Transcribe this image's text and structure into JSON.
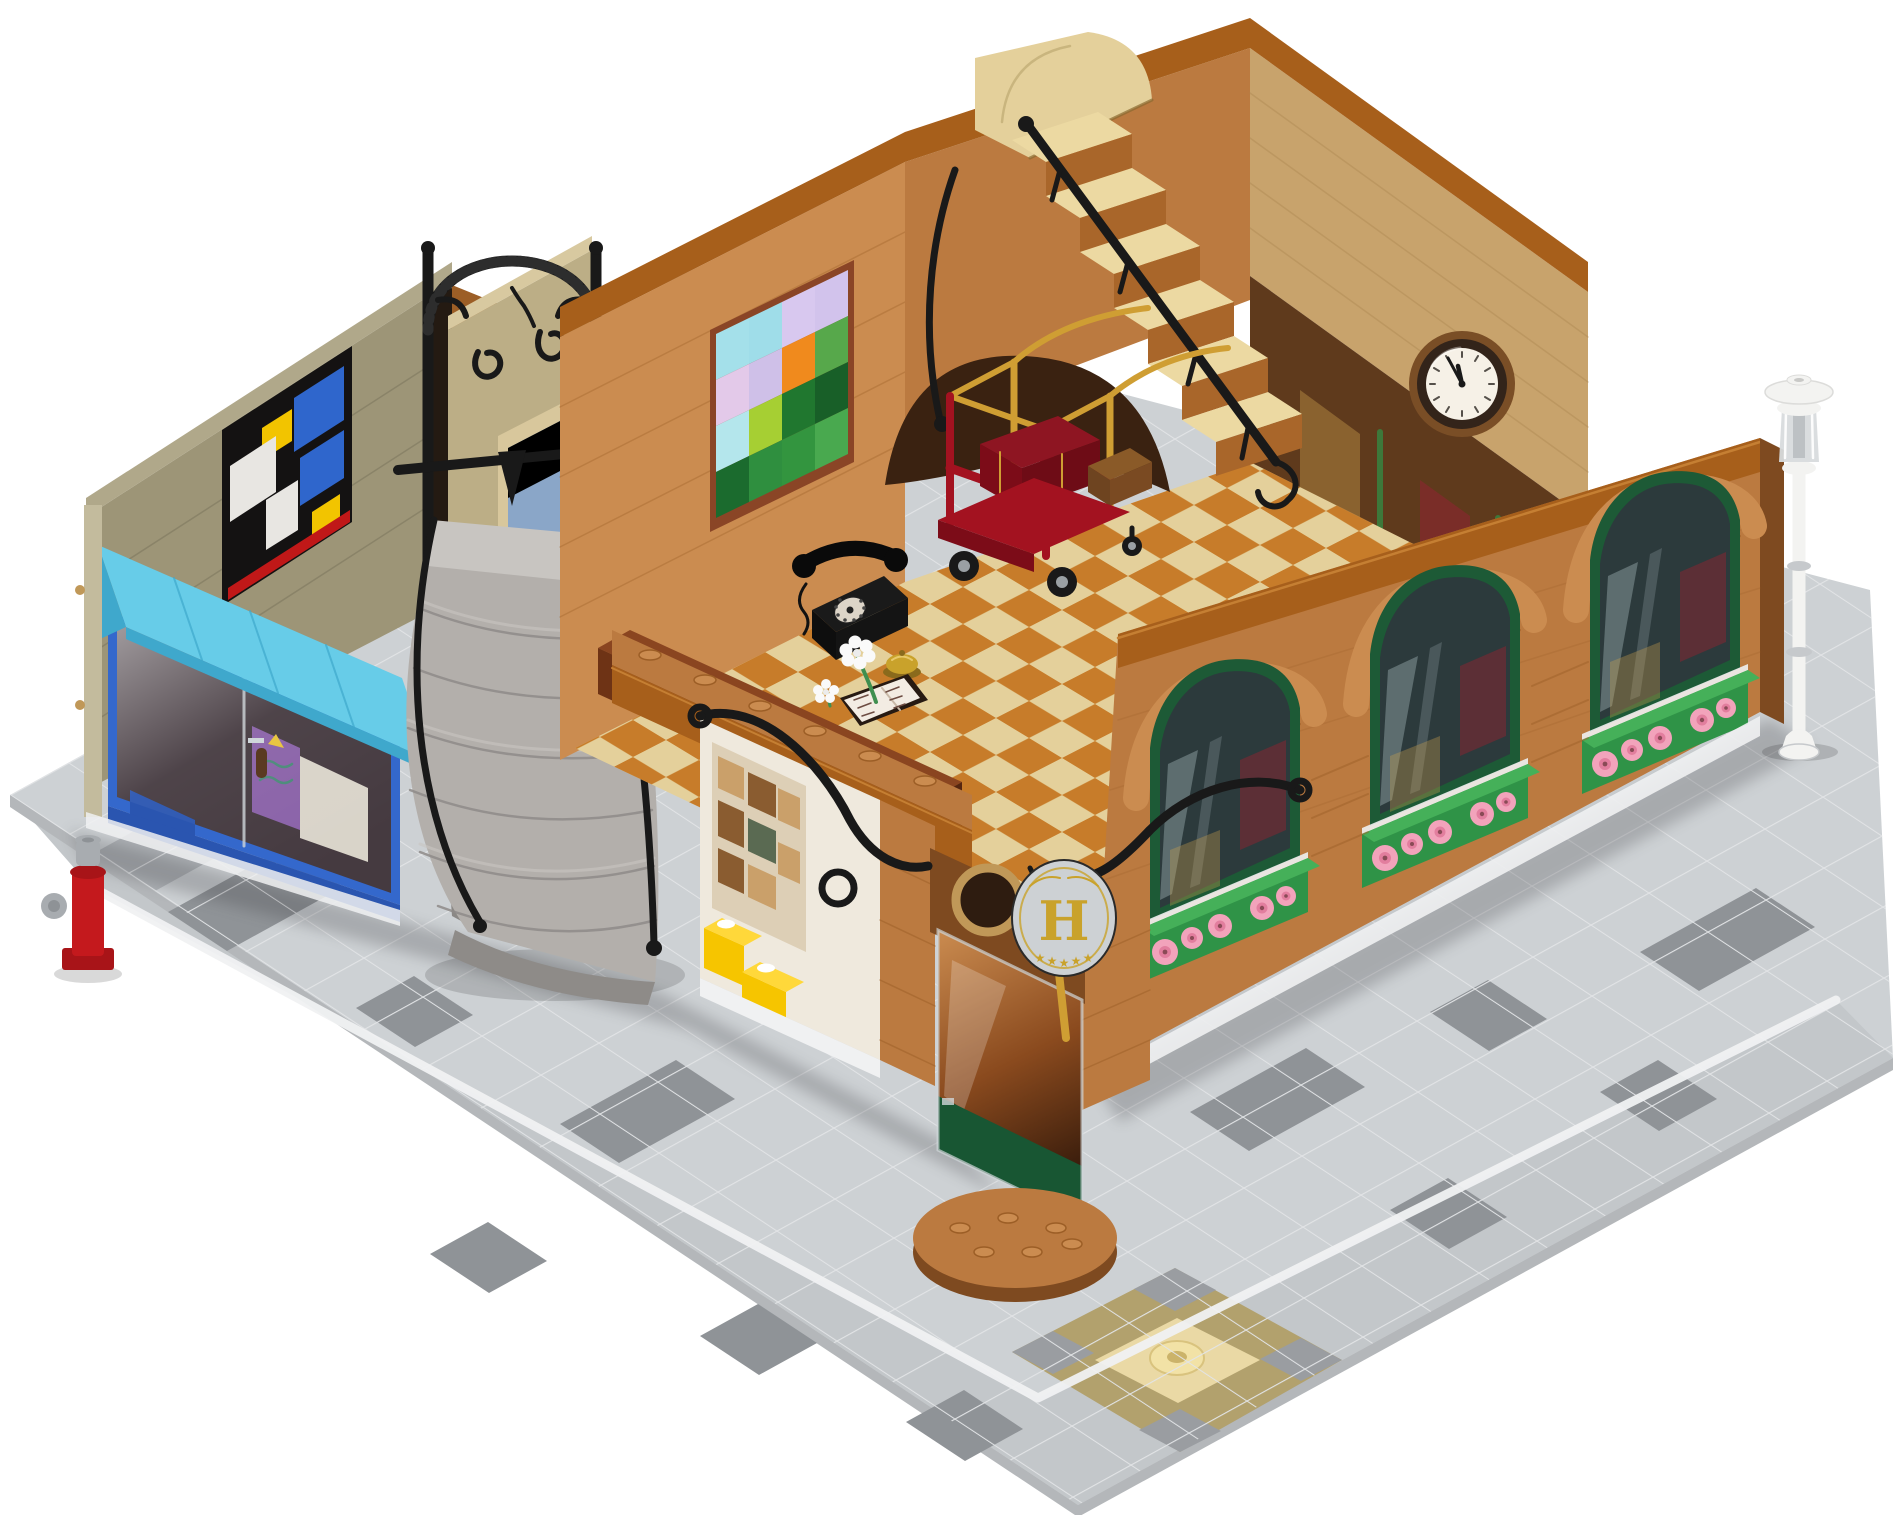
{
  "scene": {
    "subject": "LEGO modular corner building - hotel lobby with art gallery storefront, photographed as a cutaway product shot",
    "view": "three-quarter isometric view on white seamless background",
    "background_color": "#ffffff"
  },
  "sign": {
    "letter": "H",
    "star": "★",
    "star_count": 5,
    "plate_color": "#0c0c0c",
    "letter_color": "#c9a22b"
  },
  "clock": {
    "time": "11:55",
    "face_color": "#f6f1e7",
    "rim_color": "#33241a"
  },
  "mosaic": {
    "rows": [
      [
        "#a4e0ea",
        "#9fdde9",
        "#d8c8ef",
        "#d2c3ec"
      ],
      [
        "#e3c9e9",
        "#cfc0e8",
        "#f08a1d",
        "#57a84b"
      ],
      [
        "#b4e6ec",
        "#a6cf33",
        "#20772f",
        "#185f28"
      ],
      [
        "#1b6b2e",
        "#2f8f3f",
        "#33953f",
        "#49a94f"
      ]
    ]
  },
  "counts": {
    "awning_panels": 4,
    "arched_windows": 3,
    "flower_boxes": 3,
    "interior_stair_steps": 6,
    "spiral_stair_steps": 6,
    "sign_stars": 5,
    "mosaic_tiles": 16
  },
  "objects": [
    {
      "name": "art-gallery-storefront",
      "features": [
        "medium-azure awning",
        "blue framed glass door",
        "black Mondrian-style panel with blue and yellow tiles",
        "purple poster inside"
      ]
    },
    {
      "name": "fire-hydrant",
      "color_key": "hyd_red"
    },
    {
      "name": "spiral-stone-staircase",
      "color_key": "stone"
    },
    {
      "name": "wrought-iron-archway",
      "color_key": "iron"
    },
    {
      "name": "hotel-lobby",
      "features": [
        "reception desk",
        "black rotary telephone",
        "gold service bell",
        "open guest book with white daisies",
        "red luggage cart with gold rails",
        "pixel-art painting",
        "tan staircase with black railing",
        "wall clock"
      ]
    },
    {
      "name": "hotel-entrance",
      "features": [
        "glass door with dark green panel",
        "gold door handle",
        "black oval H sign with five gold stars",
        "half-round stud step",
        "sepia notice board",
        "yellow flower pots"
      ]
    },
    {
      "name": "hotel-right-facade",
      "features": [
        "three arched windows",
        "dark green window frames",
        "green flower boxes with pink flowers",
        "white curb"
      ]
    },
    {
      "name": "street-lamp",
      "color_key": "lamp_white"
    },
    {
      "name": "street-corner-medallion",
      "features": [
        "dark tan ring",
        "gray checker corners",
        "tan center",
        "round stud tile"
      ]
    }
  ],
  "colors": {
    "white": "#ffffff",
    "plate": "#cdd1d4",
    "plate_line": "#e2e4e6",
    "plate_dark": "#8f9397",
    "road": "#c3c7ca",
    "plate_side": "#b4b7ba",
    "curb": "#f0f1f2",
    "med_ring": "#b2a16d",
    "med_center": "#ead9a5",
    "med_stud": "#f2e2a6",
    "med_gray": "#9a9da1",
    "hyd_red": "#c4191d",
    "hyd_gray": "#a8acb0",
    "gal_wall": "#9d9577",
    "gal_wall_light": "#b0a88a",
    "gal_wall_dark": "#6f6a52",
    "gal_trim": "#c3bb9d",
    "awning": "#67cce8",
    "awning_dark": "#3fa8cc",
    "store_blue": "#3468cc",
    "store_blue_dark": "#2a55b0",
    "store_dark": "#453a40",
    "glass_ref": "#d2e4e9",
    "poster_purple": "#8a62a8",
    "poster_teal": "#4a8a78",
    "mond_black": "#141212",
    "tile_blue": "#2f66cc",
    "tile_yellow": "#f2c400",
    "tile_white": "#e8e6e2",
    "tile_red": "#c01818",
    "nougat": "#bb7a40",
    "nougat_light": "#cb8c50",
    "nougat_dark": "#9c5e26",
    "nougat_deep": "#7e4a20",
    "trim_orange": "#a75f1b",
    "trim_hi": "#c57f33",
    "stone": "#b3afab",
    "stone_light": "#c8c5c1",
    "stone_dark": "#8e8b88",
    "sand": "#bcae86",
    "sand_light": "#d8c9a0",
    "iron": "#191919",
    "tan": "#e4d09b",
    "floor_orange": "#c4731d",
    "wall_tan": "#c8a36c",
    "wall_tan_line": "#a9854f",
    "clock_copper": "#7a4e26",
    "clock_ring": "#33241a",
    "clock_face": "#f6f1e7",
    "tick": "#55504a",
    "green_frame": "#1d5a36",
    "glass_dark": "#2c3a3c",
    "win_red": "#8c2430",
    "win_warm": "#caa04e",
    "box_green": "#2f9347",
    "box_green_hi": "#45b059",
    "pink": "#f2a3bb",
    "pink_dark": "#e27e9e",
    "pink_hole": "#8a4a56",
    "lamp_white": "#f3f3f1",
    "lamp_trans": "#d8dbdd",
    "lamp_shade": "#c6c9cc",
    "gold": "#c9a22b",
    "brass": "#c09858",
    "desk": "#6e3315",
    "desk_dark": "#552610",
    "desk_top": "#8a4520",
    "cart_red": "#a31220",
    "cart_dark": "#7c0c18",
    "cart_gold": "#cf9e33",
    "case_brown": "#8a5a28",
    "page": "#f3ece3",
    "cover": "#271a12",
    "scribble": "#6d4c42",
    "step_tan": "#ecd9a2",
    "riser": "#a9662a",
    "white_wall": "#efe9dd",
    "board": "#ddcfb6",
    "sepia": "#caa06a",
    "sepia_dark": "#8a5c30",
    "yellow": "#f6c500",
    "yellow_hi": "#ffd83a",
    "door_green": "#185633",
    "opening": "#241a12",
    "under_stair": "#3a2211",
    "interior_dark": "#5f3a1c",
    "blue_pane": "#8aa6c8",
    "shadow": "#3c3c42"
  }
}
